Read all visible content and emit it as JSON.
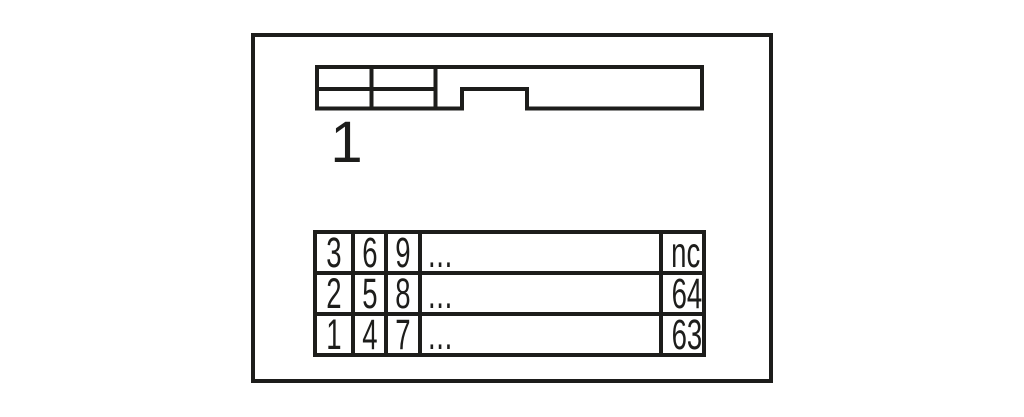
{
  "colors": {
    "ink": "#1d1d1b",
    "background": "#ffffff"
  },
  "connector": {
    "pin1_label": "1"
  },
  "pin_table": {
    "rows": [
      [
        "3",
        "6",
        "9",
        "...",
        "nc"
      ],
      [
        "2",
        "5",
        "8",
        "...",
        "64"
      ],
      [
        "1",
        "4",
        "7",
        "...",
        "63"
      ]
    ]
  }
}
